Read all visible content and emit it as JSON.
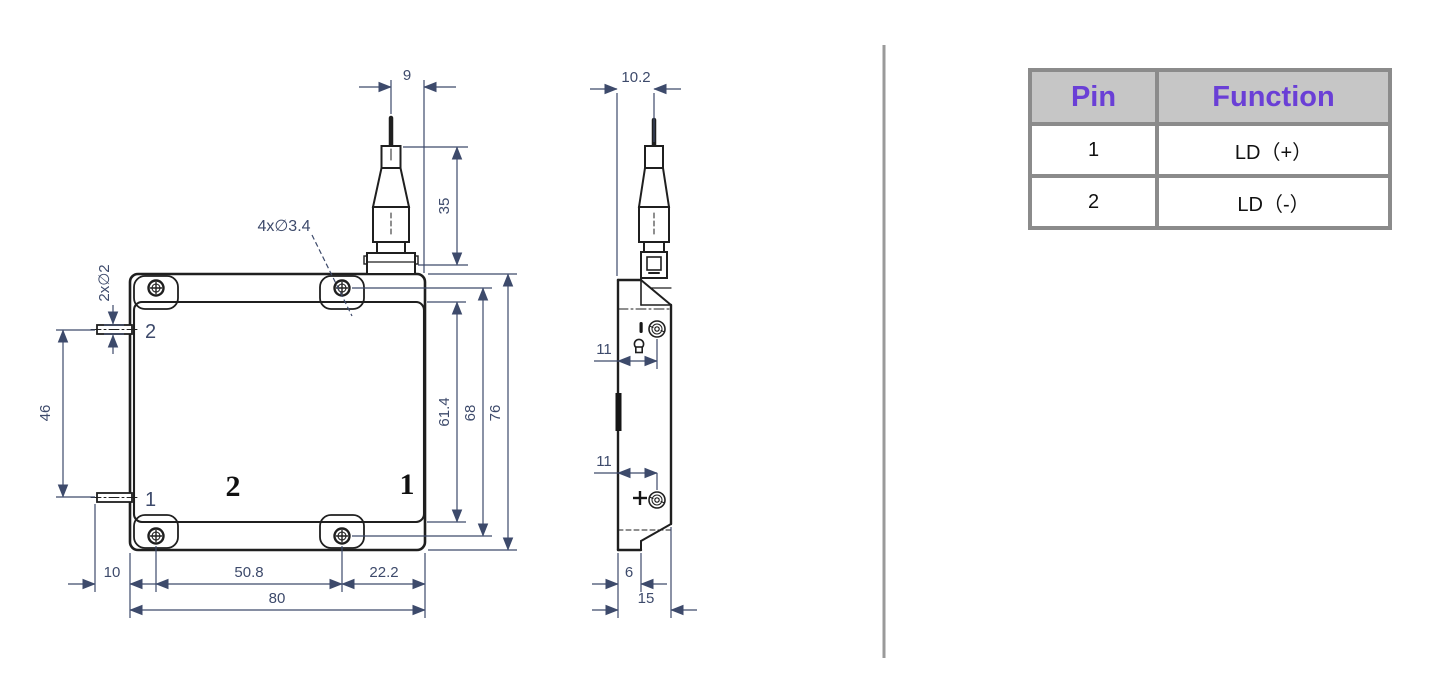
{
  "colors": {
    "line": "#1f1f1f",
    "dimension": "#3d4a6b",
    "divider": "#9a9a9a",
    "table_border": "#8b8b8b",
    "table_header_bg": "#c6c6c6",
    "table_header_text": "#6a3fd6"
  },
  "front_view": {
    "dims": {
      "fiber_offset": "9",
      "connector_height": "35",
      "mount_holes": "4x∅3.4",
      "pin_diameter": "2x∅2",
      "pin_spacing": "46",
      "panel_height": "61.4",
      "hole_spacing_vertical": "68",
      "body_height": "76",
      "pin_length": "10",
      "hole_spacing_horizontal": "50.8",
      "hole_to_edge": "22.2",
      "body_width": "80"
    },
    "pin_labels": {
      "top": "2",
      "bottom": "1"
    },
    "panel_labels": {
      "left": "2",
      "right": "1"
    }
  },
  "side_view": {
    "dims": {
      "connector_offset": "10.2",
      "screw_offset_top": "11",
      "screw_offset_bottom": "11",
      "base_width": "6",
      "total_depth": "15"
    }
  },
  "pin_table": {
    "headers": {
      "pin": "Pin",
      "function": "Function"
    },
    "rows": [
      {
        "pin": "1",
        "function": "LD（+）"
      },
      {
        "pin": "2",
        "function": "LD（-）"
      }
    ]
  }
}
